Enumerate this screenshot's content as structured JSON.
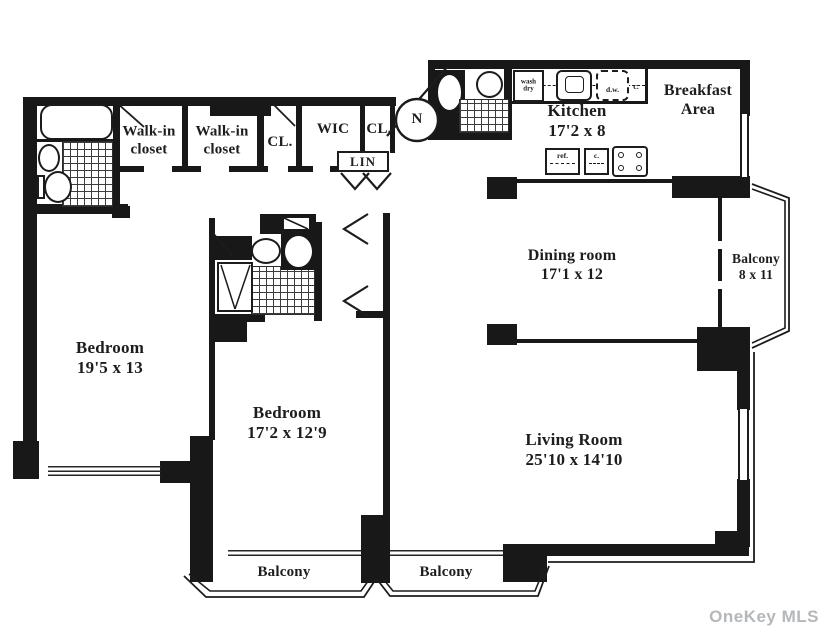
{
  "rooms": {
    "bedroom1": {
      "name": "Bedroom",
      "dims": "19'5 x 13"
    },
    "bedroom2": {
      "name": "Bedroom",
      "dims": "17'2 x 12'9"
    },
    "living_room": {
      "name": "Living Room",
      "dims": "25'10 x 14'10"
    },
    "dining_room": {
      "name": "Dining room",
      "dims": "17'1 x 12"
    },
    "kitchen": {
      "name": "Kitchen",
      "dims": "17'2 x 8"
    },
    "breakfast_area": {
      "name": "Breakfast",
      "name2": "Area"
    },
    "balcony_right": {
      "name": "Balcony",
      "dims": "8 x 11"
    },
    "balcony_left": {
      "name": "Balcony"
    },
    "balcony_mid": {
      "name": "Balcony"
    },
    "walkin_closet1": {
      "name": "Walk-in",
      "name2": "closet"
    },
    "walkin_closet2": {
      "name": "Walk-in",
      "name2": "closet"
    },
    "closet1": {
      "name": "CL."
    },
    "wic": {
      "name": "WIC"
    },
    "closet2": {
      "name": "CL."
    },
    "linen_closet": {
      "name": "LIN"
    }
  },
  "fixtures": {
    "washer_line1": "wash",
    "washer_line2": "dry",
    "dishwasher": "d.w.",
    "cabinet_top": "c.",
    "refrigerator": "ref.",
    "cabinet_bottom": "c."
  },
  "compass": {
    "north": "N"
  },
  "watermark": "OneKey MLS",
  "colors": {
    "line": "#181818",
    "watermark": "#b5b8bb",
    "background": "#ffffff"
  }
}
